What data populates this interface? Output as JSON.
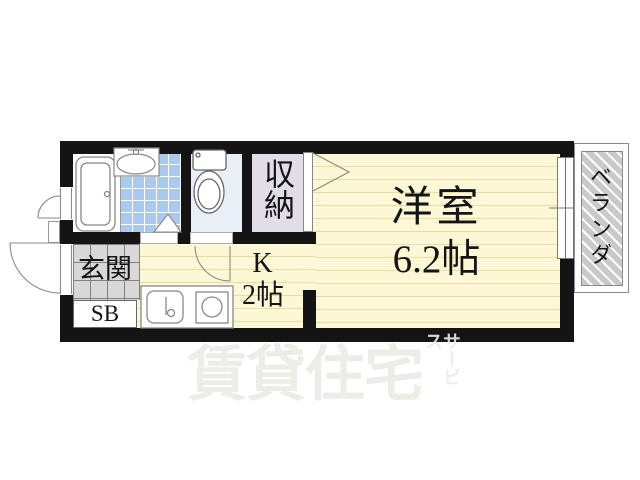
{
  "document_type": "apartment floor plan",
  "rooms": {
    "western": {
      "name": "洋室",
      "size": "6.2帖"
    },
    "kitchen": {
      "name": "K",
      "size": "2帖"
    },
    "closet": {
      "name": "収納"
    },
    "entrance": {
      "name": "玄関"
    },
    "shoe_box": {
      "name": "SB"
    },
    "veranda": {
      "name": "ベランダ"
    }
  },
  "watermark": {
    "main": "賃貸住宅",
    "sub": "サービス"
  },
  "fixtures": [
    "bathtub",
    "washbasin",
    "toilet",
    "kitchen-sink",
    "stove",
    "sliding-window",
    "entrance-door",
    "bath-door",
    "toilet-door",
    "washroom-folding-door",
    "closet-folding-door"
  ],
  "colors": {
    "wall": "#141414",
    "room_floor": "#fcf7d5",
    "floor_stripe": "#eed9a2",
    "washroom_tile": "#a9c9ef",
    "toilet_floor": "#e9eff7",
    "closet_floor": "#e2dee9",
    "entrance_tile": "#d8d8d8",
    "veranda_hatch": "#c9c9c9",
    "fixture_outline": "#888888",
    "watermark_text": "#ebebe6"
  }
}
